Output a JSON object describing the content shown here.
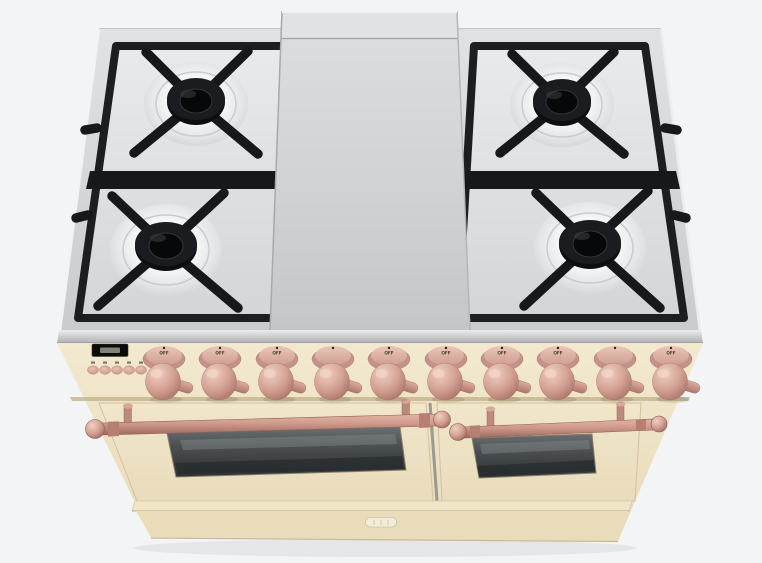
{
  "scene": {
    "description": "3D product render of a freestanding dual-fuel range, antique white finish with copper trim, 4 gas burners and center griddle over two oven doors",
    "background_color": "#f3f4f6"
  },
  "range": {
    "finish_color": "#eee3c6",
    "trim_color": "#cf9a8d",
    "cooktop": {
      "surface_color": "#d6d8d9",
      "burner_count": 4,
      "grate_color": "#17181a",
      "griddle_color": "#d2d4d6"
    },
    "control_panel": {
      "display": {
        "value": ""
      },
      "buttons": [
        {
          "label": ""
        },
        {
          "label": ""
        },
        {
          "label": ""
        },
        {
          "label": ""
        },
        {
          "label": ""
        }
      ],
      "knobs": [
        {
          "label": "OFF"
        },
        {
          "label": "OFF"
        },
        {
          "label": "OFF"
        },
        {
          "label": ""
        },
        {
          "label": "OFF"
        },
        {
          "label": "OFF"
        },
        {
          "label": "OFF"
        },
        {
          "label": "OFF"
        },
        {
          "label": ""
        },
        {
          "label": "OFF"
        }
      ]
    },
    "ovens": {
      "door_count": 2,
      "glass_color": "#393d40",
      "handle_color": "#cf9a8d"
    },
    "badge": {
      "text": ""
    }
  }
}
